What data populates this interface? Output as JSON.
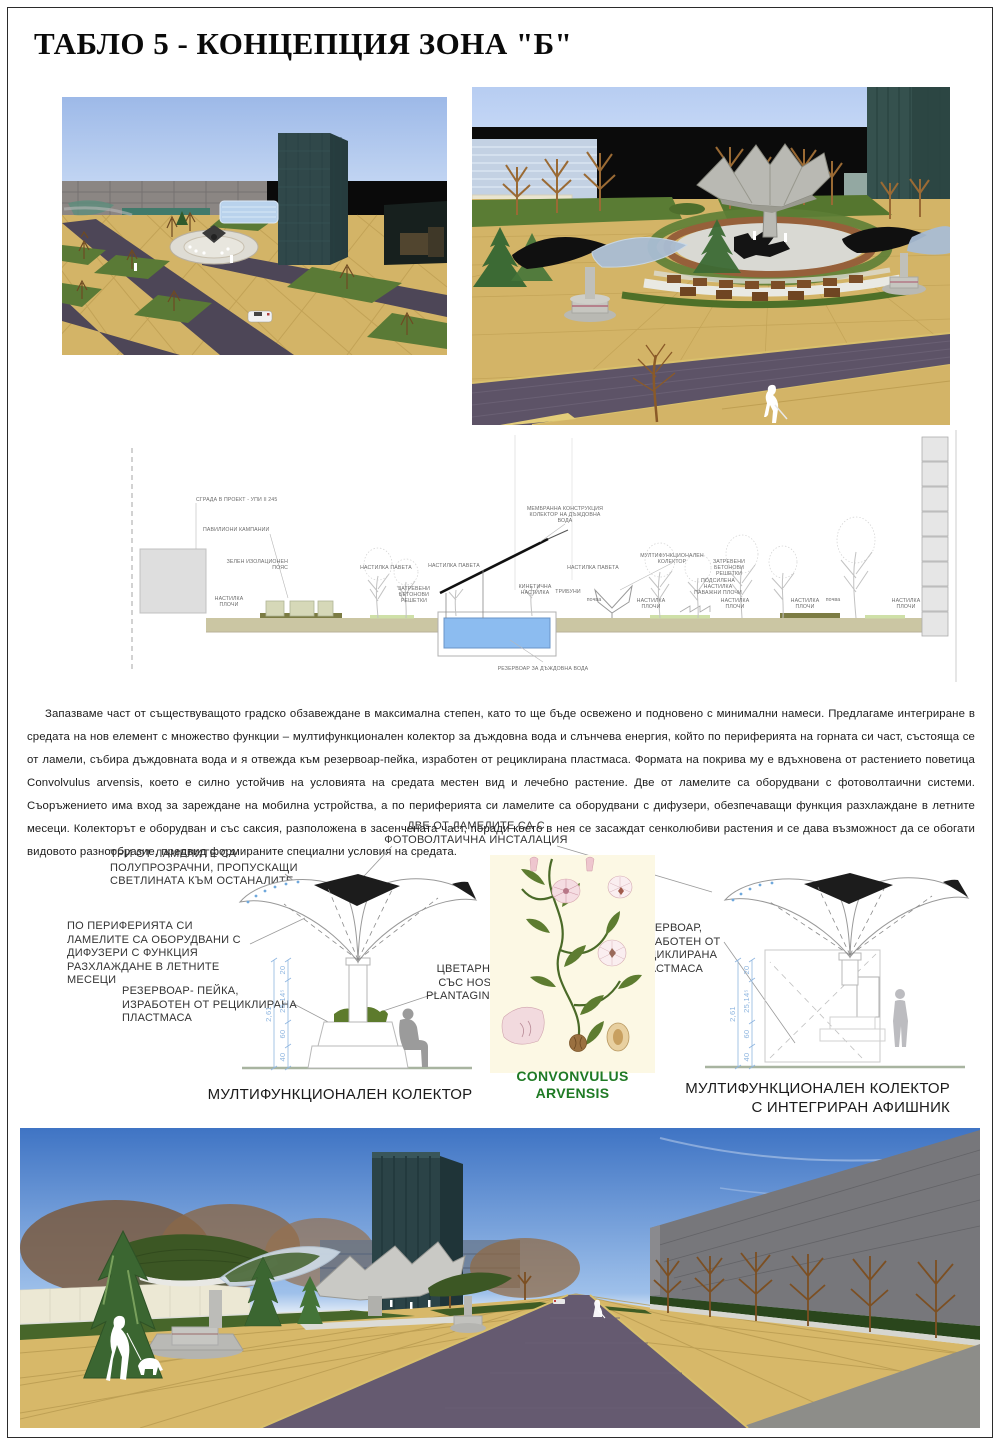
{
  "page": {
    "title": "ТАБЛО 5 - КОНЦЕПЦИЯ ЗОНА \"Б\""
  },
  "paragraph": {
    "text": "Запазваме част от съществуващото градско обзавеждане в максимална степен, като то ще бъде освежено и подновено с минимални намеси. Предлагаме интегриране в средата на нов елемент с множество функции – мултифункционален колектор за дъждовна вода и слънчева енергия, който по периферията на горната си част, състояща се от ламели, събира дъждовната вода и я отвежда към резервоар-пейка, изработен от рециклирана пластмаса. Формата на покрива му е вдъхновена от растението поветица Convolvulus arvensis, което е силно устойчив на условията на средата местен вид и лечебно растение. Две от ламелите са оборудвани с фотоволтаични системи. Съоръжението има вход за зареждане на мобилна устройства, а по периферията си ламелите са оборудвани с дифузери, обезпечаващи функция разхлаждане в летните месеци. Колекторът е оборудван и със саксия, разположена в засенчената част, поради което в нея се засаждат сенколюбиви растения и се дава възможност да се обогати видовото разнообразие, предвид формираните специални условия на средата."
  },
  "section": {
    "annotations": [
      {
        "x": 76,
        "y": 71,
        "anchor": "start",
        "lines": [
          "СГРАДА В ПРОЕКТ - УПИ II 245"
        ]
      },
      {
        "x": 83,
        "y": 101,
        "anchor": "start",
        "lines": [
          "ПАВИЛИОНИ КАМПАНИИ"
        ]
      },
      {
        "x": 168,
        "y": 133,
        "anchor": "end",
        "lines": [
          "ЗЕЛЕН ИЗОЛАЦИОНЕН",
          "ПОЯС"
        ]
      },
      {
        "x": 109,
        "y": 170,
        "anchor": "middle",
        "lines": [
          "НАСТИЛКА",
          "ПЛОЧИ"
        ]
      },
      {
        "x": 266,
        "y": 139,
        "anchor": "middle",
        "lines": [
          "НАСТИЛКА ПАВЕТА"
        ]
      },
      {
        "x": 294,
        "y": 160,
        "anchor": "middle",
        "lines": [
          "ЗАТРЕВЕНИ",
          "БЕТОНОВИ",
          "РЕШЕТКИ"
        ]
      },
      {
        "x": 334,
        "y": 137,
        "anchor": "middle",
        "lines": [
          "НАСТИЛКА ПАВЕТА"
        ]
      },
      {
        "x": 445,
        "y": 80,
        "anchor": "middle",
        "lines": [
          "МЕМБРАННА КОНСТРУКЦИЯ",
          "КОЛЕКТОР НА ДЪЖДОВНА",
          "ВОДА"
        ]
      },
      {
        "x": 415,
        "y": 158,
        "anchor": "middle",
        "lines": [
          "КИНЕТИЧНА",
          "НАСТИЛКА"
        ]
      },
      {
        "x": 448,
        "y": 163,
        "anchor": "middle",
        "lines": [
          "ТРИБУНИ"
        ]
      },
      {
        "x": 474,
        "y": 171,
        "anchor": "middle",
        "lines": [
          "почва"
        ]
      },
      {
        "x": 473,
        "y": 139,
        "anchor": "middle",
        "lines": [
          "НАСТИЛКА ПАВЕТА"
        ]
      },
      {
        "x": 552,
        "y": 127,
        "anchor": "middle",
        "lines": [
          "МУЛТИФУНКЦИОНАЛЕН",
          "КОЛЕКТОР"
        ]
      },
      {
        "x": 609,
        "y": 133,
        "anchor": "middle",
        "lines": [
          "ЗАТРЕВЕНИ",
          "БЕТОНОВИ",
          "РЕШЕТКИ"
        ]
      },
      {
        "x": 598,
        "y": 152,
        "anchor": "middle",
        "lines": [
          "ПОДСИЛЕНА",
          "НАСТИЛКА",
          "ПАВАЖНИ ПЛОЧИ"
        ]
      },
      {
        "x": 531,
        "y": 172,
        "anchor": "middle",
        "lines": [
          "НАСТИЛКА",
          "ПЛОЧИ"
        ]
      },
      {
        "x": 615,
        "y": 172,
        "anchor": "middle",
        "lines": [
          "НАСТИЛКА",
          "ПЛОЧИ"
        ]
      },
      {
        "x": 685,
        "y": 172,
        "anchor": "middle",
        "lines": [
          "НАСТИЛКА",
          "ПЛОЧИ"
        ]
      },
      {
        "x": 713,
        "y": 171,
        "anchor": "middle",
        "lines": [
          "почва"
        ]
      },
      {
        "x": 786,
        "y": 172,
        "anchor": "middle",
        "lines": [
          "НАСТИЛКА",
          "ПЛОЧИ"
        ]
      },
      {
        "x": 423,
        "y": 240,
        "anchor": "middle",
        "lines": [
          "РЕЗЕРВОАР ЗА ДЪЖДОВНА ВОДА"
        ]
      }
    ]
  },
  "diagrams": {
    "callout_photovoltaic": "ДВЕ ОТ ЛАМЕЛИТЕ СА С\nФОТОВОЛТАИЧНА ИНСТАЛАЦИЯ",
    "callout_translucent": "ТРИ ОТ ЛАМЕЛИТЕ СА\nПОЛУПРОЗРАЧНИ, ПРОПУСКАЩИ\nСВЕТЛИНАТА КЪМ ОСТАНАЛИТЕ",
    "callout_diffusers": "ПО ПЕРИФЕРИЯТА СИ\nЛАМЕЛИТЕ СА ОБОРУДВАНИ С\nДИФУЗЕРИ С ФУНКЦИЯ\nРАЗХЛАЖДАНЕ В ЛЕТНИТЕ\nМЕСЕЦИ",
    "callout_reservoir_bench": "РЕЗЕРВОАР-  ПЕЙКА,\nИЗРАБОТЕН ОТ РЕЦИКЛИРАНА\nПЛАСТМАСА",
    "callout_planter": "ЦВЕТАРНИК\nСЪС  HOSTA\nPLANTAGINEA",
    "callout_reservoir": "РЕЗЕРВОАР,\nИЗРАБОТЕН ОТ\nРЕЦИКЛИРАНА\nПЛАСТМАСА",
    "caption_left": "МУЛТИФУНКЦИОНАЛЕН КОЛЕКТОР",
    "caption_center": "CONVONVULUS\nARVENSIS",
    "caption_right": "МУЛТИФУНКЦИОНАЛЕН КОЛЕКТОР\nС ИНТЕГРИРАН АФИШНИК",
    "dimensions": {
      "total": "2,61",
      "seg_40": "40",
      "seg_60": "60",
      "seg_25": "25,14⁵",
      "seg_20": "20"
    }
  },
  "colors": {
    "accent_green": "#1f7a24",
    "dimension_blue": "#8fb6e0",
    "paving_tan": "#d3b467",
    "road_purple": "#4d4657",
    "water_blue": "#8cbcf0"
  }
}
